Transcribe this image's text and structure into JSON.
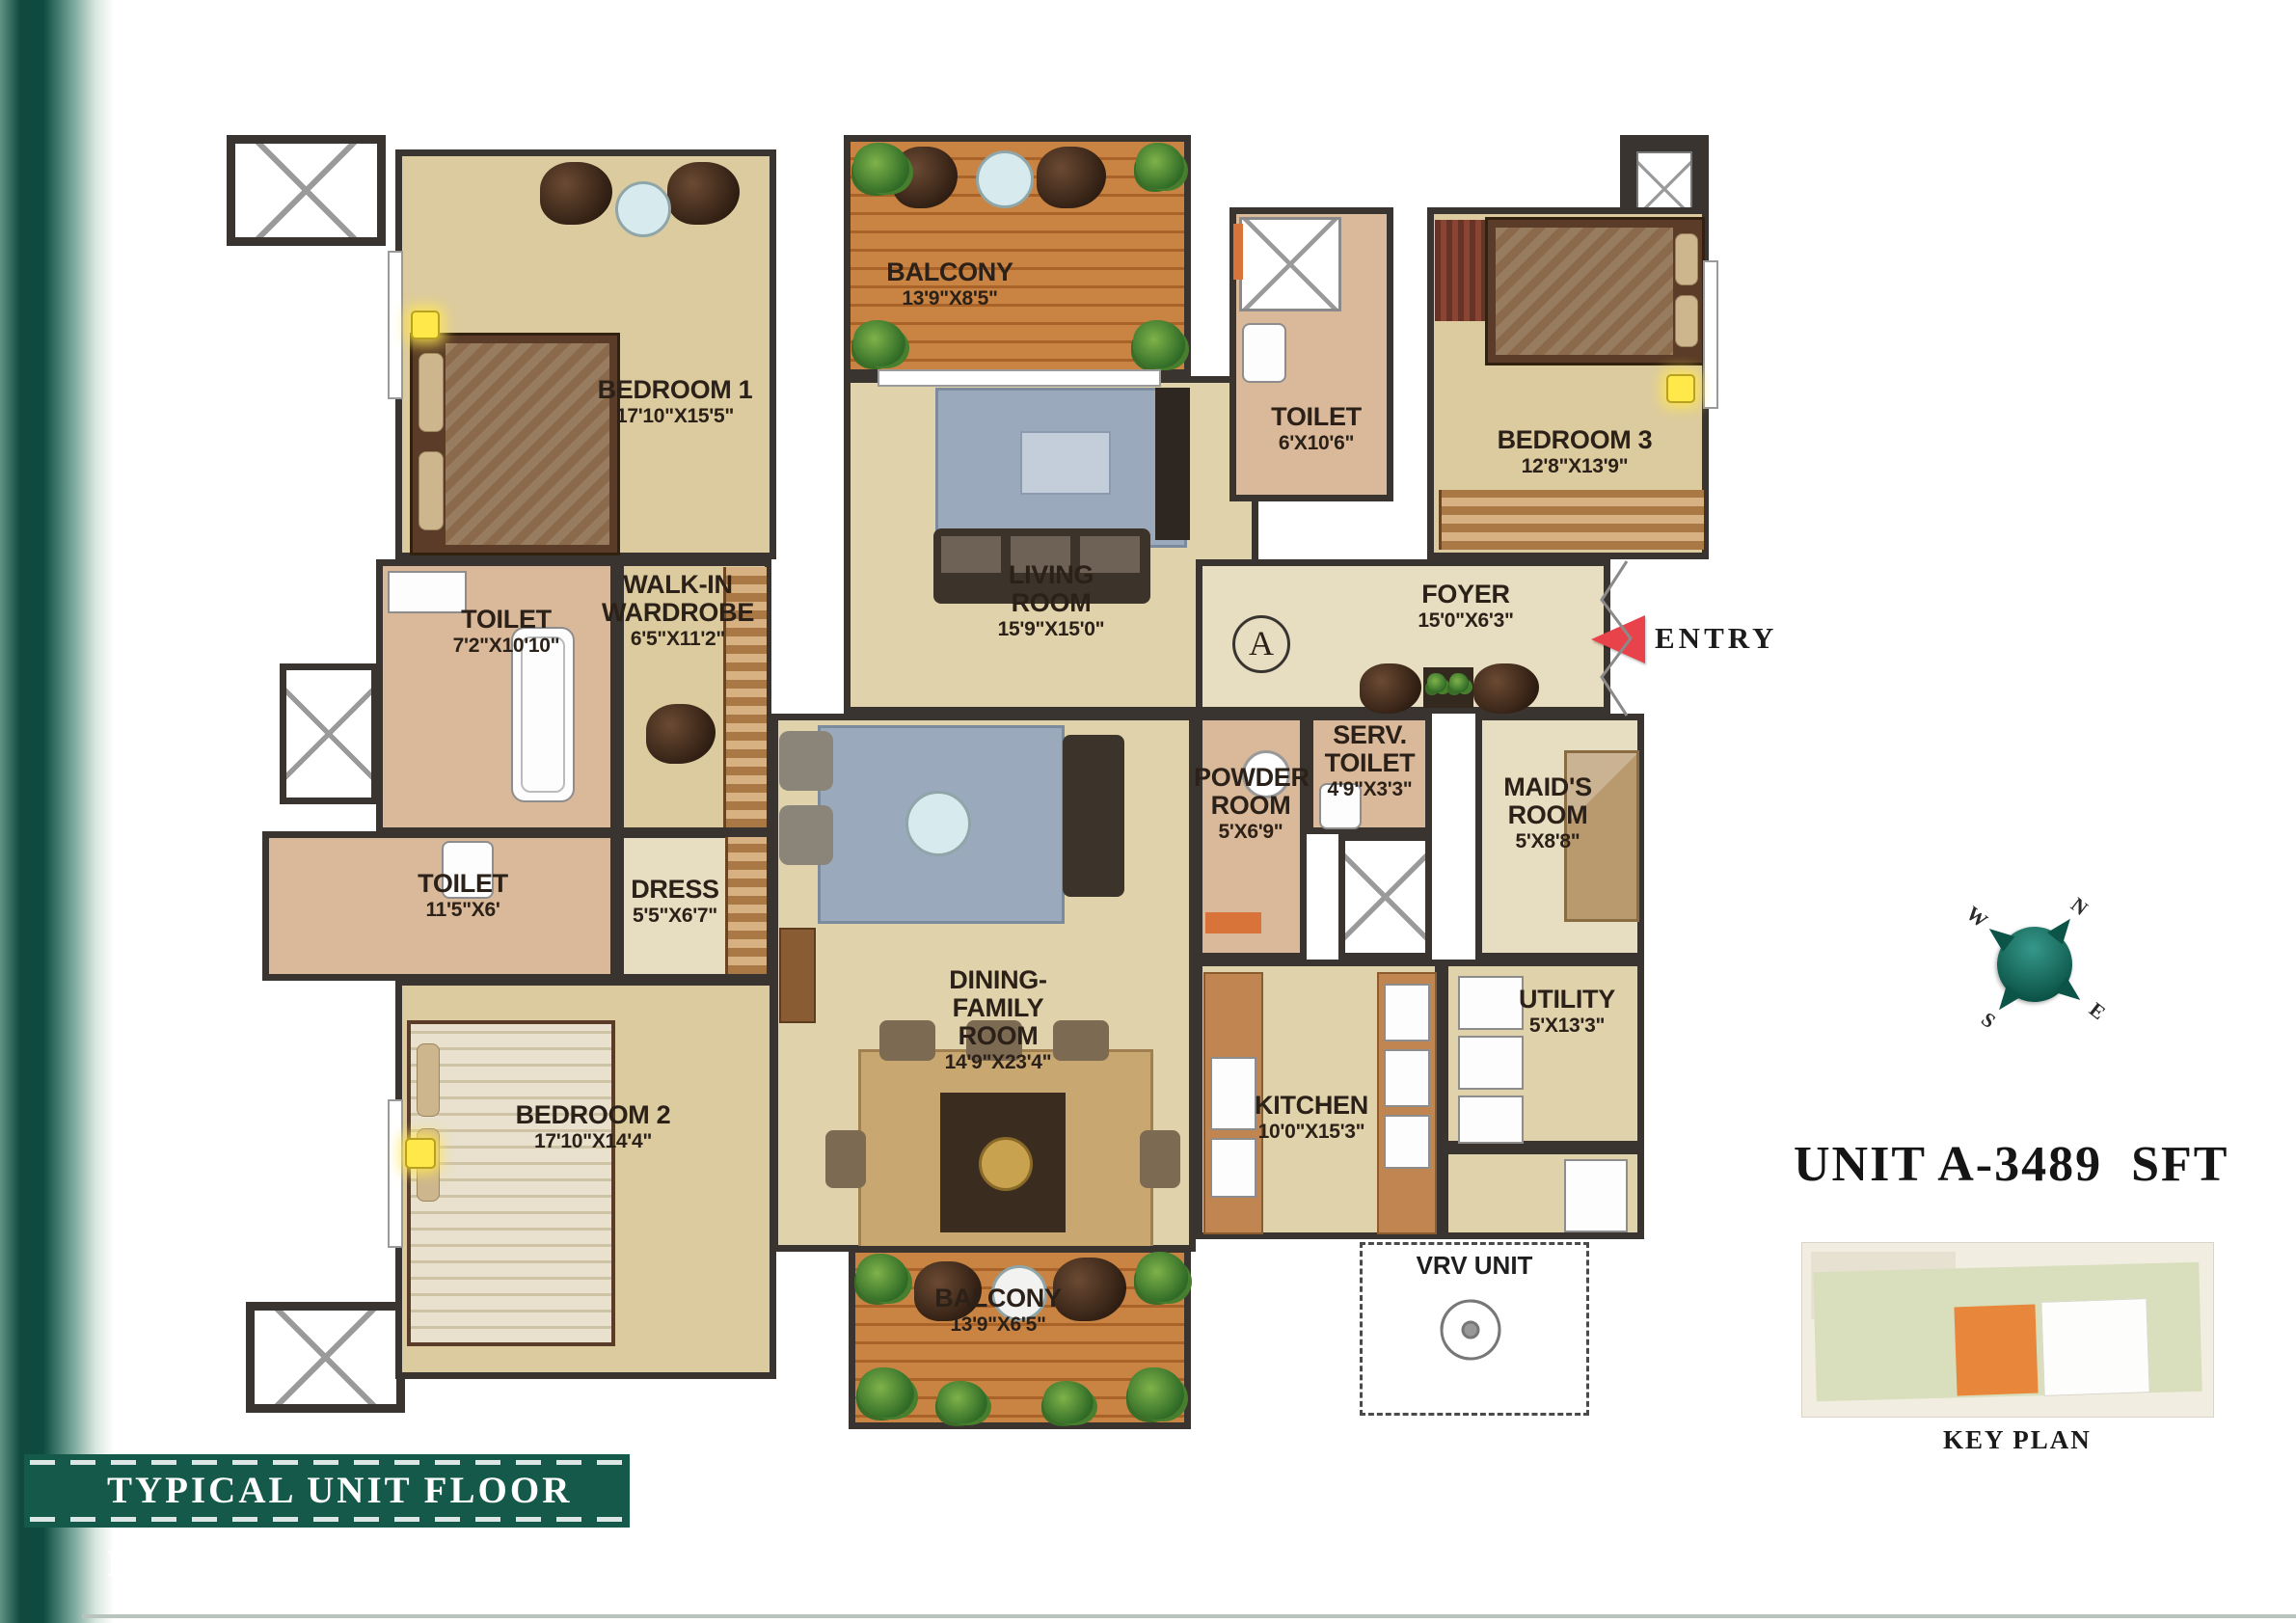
{
  "page": {
    "banner_title": "TYPICAL UNIT FLOOR PLAN",
    "unit_area_label": "UNIT A-3489  SFT",
    "key_plan_label": "KEY PLAN",
    "entry_label": "ENTRY",
    "section_marker": "A",
    "vrv_unit_label": "VRV UNIT"
  },
  "compass": {
    "north": "N",
    "east": "E",
    "south": "S",
    "west": "W"
  },
  "rooms": {
    "bedroom1": {
      "name": "BEDROOM 1",
      "dims": "17'10\"X15'5\""
    },
    "balcony_top": {
      "name": "BALCONY",
      "dims": "13'9\"X8'5\""
    },
    "toilet_top": {
      "name": "TOILET",
      "dims": "6'X10'6\""
    },
    "bedroom3": {
      "name": "BEDROOM 3",
      "dims": "12'8\"X13'9\""
    },
    "living": {
      "name": "LIVING\nROOM",
      "dims": "15'9\"X15'0\""
    },
    "foyer": {
      "name": "FOYER",
      "dims": "15'0\"X6'3\""
    },
    "toilet_master": {
      "name": "TOILET",
      "dims": "7'2\"X10'10\""
    },
    "wardrobe": {
      "name": "WALK-IN\nWARDROBE",
      "dims": "6'5\"X11'2\""
    },
    "toilet2": {
      "name": "TOILET",
      "dims": "11'5\"X6'"
    },
    "dress": {
      "name": "DRESS",
      "dims": "5'5\"X6'7\""
    },
    "dining": {
      "name": "DINING-\nFAMILY\nROOM",
      "dims": "14'9\"X23'4\""
    },
    "powder": {
      "name": "POWDER\nROOM",
      "dims": "5'X6'9\""
    },
    "serv_toilet": {
      "name": "SERV.\nTOILET",
      "dims": "4'9\"X3'3\""
    },
    "maids": {
      "name": "MAID'S\nROOM",
      "dims": "5'X8'8\""
    },
    "utility": {
      "name": "UTILITY",
      "dims": "5'X13'3\""
    },
    "kitchen": {
      "name": "KITCHEN",
      "dims": "10'0\"X15'3\""
    },
    "bedroom2": {
      "name": "BEDROOM 2",
      "dims": "17'10\"X14'4\""
    },
    "balcony_bottom": {
      "name": "BALCONY",
      "dims": "13'9\"X6'5\""
    }
  },
  "colors": {
    "banner_bg": "#15594b",
    "wall": "#3a3430",
    "floor_tan": "#dccb9f",
    "toilet_floor": "#d9b999",
    "balcony_wood": "#c98443",
    "entry_arrow": "#e8434a",
    "compass_teal": "#0c5448",
    "keyplan_highlight": "#e8873c",
    "keyplan_field": "#d9debc"
  }
}
